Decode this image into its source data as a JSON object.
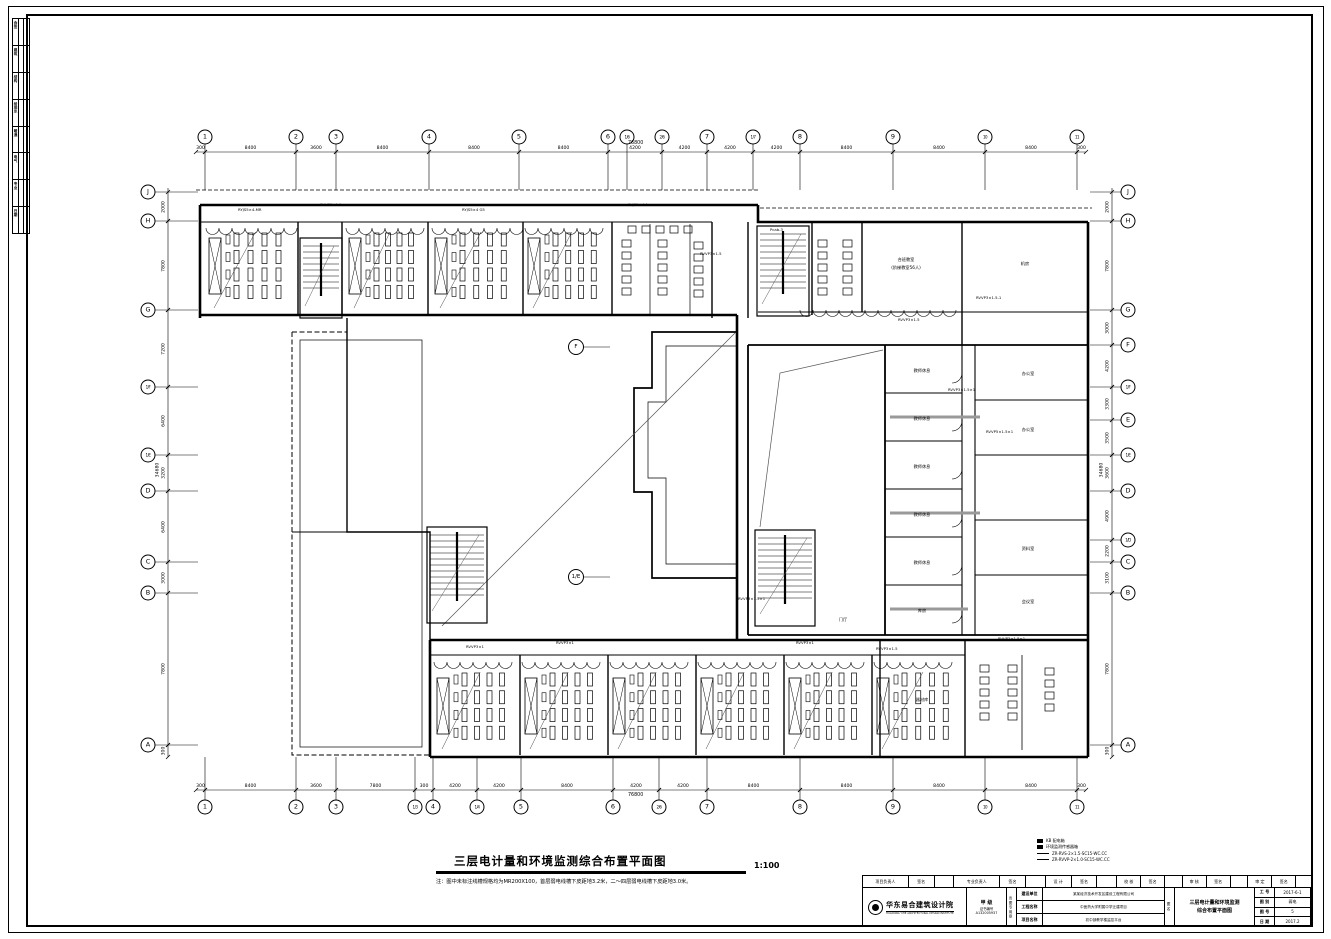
{
  "drawing": {
    "title": "三层电计量和环境监测综合布置平面图",
    "scale": "1:100",
    "note": "注：图中未标注线槽规格均为MR200X100，首层弱电线槽下皮距地3.2米，二～四层弱电线槽下皮距地3.0米。"
  },
  "legend": {
    "rows": [
      {
        "sym": "box",
        "label": "KB 配电箱"
      },
      {
        "sym": "box",
        "label": "环境监测传感器箱"
      },
      {
        "sym": "line",
        "label": "ZR-RVS-2×1.5-SC15-WC.CC"
      },
      {
        "sym": "line",
        "label": "ZR-RVVP-2×1.0-SC15-WC.CC"
      }
    ]
  },
  "signstrip": {
    "rows": [
      "会签",
      "建筑",
      "结构",
      "给排水",
      "暖通",
      "电气",
      "专业",
      "日期"
    ]
  },
  "titleblock": {
    "row1": [
      "项目负责人",
      "签名",
      "",
      "专业负责人",
      "签名",
      "",
      "设 计",
      "签名",
      "",
      "校 核",
      "签名",
      "",
      "审 核",
      "签名",
      "",
      "审 定",
      "签名",
      ""
    ],
    "company": "华东易合建筑设计院",
    "company_en": "HUADONG YIHE ARCHITECTURAL DESIGN INSTITUTE",
    "cert_grade": "甲 级",
    "cert_label": "证书编号",
    "cert_no": "A132005937",
    "stamp_vertical": "出图专用章",
    "fields": [
      {
        "label": "建设单位",
        "value": "某某经济技术开发区建设工程有限公司"
      },
      {
        "label": "工程名称",
        "value": "中医药大学附属中学迁建项目"
      },
      {
        "label": "项目名称",
        "value": "初中部教学楼监控平台"
      }
    ],
    "name_col_vertical": "图名",
    "drawing_name_line1": "三层电计量和环境监测",
    "drawing_name_line2": "综合布置平面图",
    "meta": [
      {
        "label": "工 号",
        "value": "2017-6-1"
      },
      {
        "label": "图 别",
        "value": "弱电"
      },
      {
        "label": "图 号",
        "value": "5"
      },
      {
        "label": "日 期",
        "value": "2017.2"
      }
    ]
  },
  "grid": {
    "top": [
      {
        "l": "1",
        "x": 205
      },
      {
        "l": "2",
        "x": 296
      },
      {
        "l": "3",
        "x": 336
      },
      {
        "l": "4",
        "x": 429
      },
      {
        "l": "5",
        "x": 519
      },
      {
        "l": "6",
        "x": 608
      },
      {
        "l": "1/6",
        "x": 627
      },
      {
        "l": "2/6",
        "x": 662
      },
      {
        "l": "7",
        "x": 707
      },
      {
        "l": "1/7",
        "x": 753
      },
      {
        "l": "8",
        "x": 800
      },
      {
        "l": "9",
        "x": 893
      },
      {
        "l": "10",
        "x": 985
      },
      {
        "l": "11",
        "x": 1077
      }
    ],
    "bottom": [
      {
        "l": "1",
        "x": 205
      },
      {
        "l": "2",
        "x": 296
      },
      {
        "l": "3",
        "x": 336
      },
      {
        "l": "1/3",
        "x": 415
      },
      {
        "l": "4",
        "x": 433
      },
      {
        "l": "1/4",
        "x": 477
      },
      {
        "l": "5",
        "x": 521
      },
      {
        "l": "6",
        "x": 613
      },
      {
        "l": "2/6",
        "x": 659
      },
      {
        "l": "7",
        "x": 707
      },
      {
        "l": "8",
        "x": 800
      },
      {
        "l": "9",
        "x": 893
      },
      {
        "l": "10",
        "x": 985
      },
      {
        "l": "11",
        "x": 1077
      }
    ],
    "left": [
      {
        "l": "J",
        "y": 192
      },
      {
        "l": "H",
        "y": 221
      },
      {
        "l": "G",
        "y": 310
      },
      {
        "l": "1/F",
        "y": 387
      },
      {
        "l": "1/E",
        "y": 455
      },
      {
        "l": "D",
        "y": 491
      },
      {
        "l": "C",
        "y": 562
      },
      {
        "l": "B",
        "y": 593
      },
      {
        "l": "A",
        "y": 745
      }
    ],
    "right": [
      {
        "l": "J",
        "y": 192
      },
      {
        "l": "H",
        "y": 221
      },
      {
        "l": "G",
        "y": 310
      },
      {
        "l": "F",
        "y": 345
      },
      {
        "l": "1/F",
        "y": 387
      },
      {
        "l": "E",
        "y": 420
      },
      {
        "l": "1/E",
        "y": 455
      },
      {
        "l": "D",
        "y": 491
      },
      {
        "l": "1/D",
        "y": 540
      },
      {
        "l": "C",
        "y": 562
      },
      {
        "l": "B",
        "y": 593
      },
      {
        "l": "A",
        "y": 745
      }
    ],
    "dims_top": [
      {
        "x1": 196,
        "x2": 205,
        "v": "300"
      },
      {
        "x1": 205,
        "x2": 296,
        "v": "8400"
      },
      {
        "x1": 296,
        "x2": 336,
        "v": "3600"
      },
      {
        "x1": 336,
        "x2": 429,
        "v": "8400"
      },
      {
        "x1": 429,
        "x2": 519,
        "v": "8400"
      },
      {
        "x1": 519,
        "x2": 608,
        "v": "8400"
      },
      {
        "x1": 608,
        "x2": 662,
        "v": "4200"
      },
      {
        "x1": 662,
        "x2": 707,
        "v": "4200"
      },
      {
        "x1": 707,
        "x2": 753,
        "v": "4200"
      },
      {
        "x1": 753,
        "x2": 800,
        "v": "4200"
      },
      {
        "x1": 800,
        "x2": 893,
        "v": "8400"
      },
      {
        "x1": 893,
        "x2": 985,
        "v": "8400"
      },
      {
        "x1": 985,
        "x2": 1077,
        "v": "8400"
      },
      {
        "x1": 1077,
        "x2": 1086,
        "v": "300"
      }
    ],
    "dims_bottom": [
      {
        "x1": 196,
        "x2": 205,
        "v": "300"
      },
      {
        "x1": 205,
        "x2": 296,
        "v": "8400"
      },
      {
        "x1": 296,
        "x2": 336,
        "v": "3600"
      },
      {
        "x1": 336,
        "x2": 415,
        "v": "7800"
      },
      {
        "x1": 415,
        "x2": 433,
        "v": "300"
      },
      {
        "x1": 433,
        "x2": 477,
        "v": "4200"
      },
      {
        "x1": 477,
        "x2": 521,
        "v": "4200"
      },
      {
        "x1": 521,
        "x2": 613,
        "v": "8400"
      },
      {
        "x1": 613,
        "x2": 659,
        "v": "4200"
      },
      {
        "x1": 659,
        "x2": 707,
        "v": "4200"
      },
      {
        "x1": 707,
        "x2": 800,
        "v": "8400"
      },
      {
        "x1": 800,
        "x2": 893,
        "v": "8400"
      },
      {
        "x1": 893,
        "x2": 985,
        "v": "8400"
      },
      {
        "x1": 985,
        "x2": 1077,
        "v": "8400"
      },
      {
        "x1": 1077,
        "x2": 1086,
        "v": "300"
      }
    ],
    "dims_left": [
      {
        "y1": 192,
        "y2": 221,
        "v": "2000"
      },
      {
        "y1": 221,
        "y2": 310,
        "v": "7800"
      },
      {
        "y1": 310,
        "y2": 387,
        "v": "7200"
      },
      {
        "y1": 387,
        "y2": 455,
        "v": "6400"
      },
      {
        "y1": 455,
        "y2": 491,
        "v": "3200"
      },
      {
        "y1": 491,
        "y2": 562,
        "v": "6400"
      },
      {
        "y1": 562,
        "y2": 593,
        "v": "3000"
      },
      {
        "y1": 593,
        "y2": 745,
        "v": "7800"
      },
      {
        "y1": 745,
        "y2": 757,
        "v": "300"
      }
    ],
    "dims_right": [
      {
        "y1": 192,
        "y2": 221,
        "v": "2000"
      },
      {
        "y1": 221,
        "y2": 310,
        "v": "7800"
      },
      {
        "y1": 310,
        "y2": 345,
        "v": "3000"
      },
      {
        "y1": 345,
        "y2": 387,
        "v": "4200"
      },
      {
        "y1": 387,
        "y2": 420,
        "v": "3300"
      },
      {
        "y1": 420,
        "y2": 455,
        "v": "3500"
      },
      {
        "y1": 455,
        "y2": 491,
        "v": "3600"
      },
      {
        "y1": 491,
        "y2": 540,
        "v": "4900"
      },
      {
        "y1": 540,
        "y2": 562,
        "v": "2200"
      },
      {
        "y1": 562,
        "y2": 593,
        "v": "3100"
      },
      {
        "y1": 593,
        "y2": 745,
        "v": "7800"
      },
      {
        "y1": 745,
        "y2": 757,
        "v": "300"
      }
    ],
    "total_top": "76800",
    "total_bottom": "76800",
    "total_left": "34680",
    "total_right": "34680"
  },
  "axis_refs": [
    {
      "label": "F",
      "x": 576,
      "y": 347
    },
    {
      "label": "1/E",
      "x": 576,
      "y": 577
    }
  ],
  "plan_labels": [
    {
      "x": 906,
      "y": 260,
      "t": "合班教室"
    },
    {
      "x": 906,
      "y": 268,
      "t": "(阶梯教室56人)"
    },
    {
      "x": 1025,
      "y": 264,
      "t": "机房"
    },
    {
      "x": 922,
      "y": 371,
      "t": "教师休息"
    },
    {
      "x": 922,
      "y": 419,
      "t": "教师休息"
    },
    {
      "x": 922,
      "y": 467,
      "t": "教师休息"
    },
    {
      "x": 922,
      "y": 515,
      "t": "教师休息"
    },
    {
      "x": 922,
      "y": 563,
      "t": "教师休息"
    },
    {
      "x": 922,
      "y": 611,
      "t": "库房"
    },
    {
      "x": 1028,
      "y": 374,
      "t": "办公室"
    },
    {
      "x": 1028,
      "y": 430,
      "t": "办公室"
    },
    {
      "x": 1028,
      "y": 549,
      "t": "资料室"
    },
    {
      "x": 1028,
      "y": 602,
      "t": "会议室"
    },
    {
      "x": 922,
      "y": 700,
      "t": "器材库"
    },
    {
      "x": 843,
      "y": 620,
      "t": "门厅"
    }
  ],
  "cable_labels": [
    {
      "x": 238,
      "y": 212,
      "t": "RYJS5×4-MR"
    },
    {
      "x": 320,
      "y": 207,
      "t": "RVVP3×1.5"
    },
    {
      "x": 462,
      "y": 212,
      "t": "RYJS5×4 G5"
    },
    {
      "x": 628,
      "y": 207,
      "t": "RYJS5×4-1"
    },
    {
      "x": 700,
      "y": 256,
      "t": "RVVP3×1.5"
    },
    {
      "x": 770,
      "y": 232,
      "t": "Pcab-3"
    },
    {
      "x": 898,
      "y": 322,
      "t": "RVVP3×1.5"
    },
    {
      "x": 976,
      "y": 300,
      "t": "RVVP3×1.5-1"
    },
    {
      "x": 948,
      "y": 392,
      "t": "RVVP3×1.5×1"
    },
    {
      "x": 986,
      "y": 434,
      "t": "RVVP5×1.5×1"
    },
    {
      "x": 998,
      "y": 641,
      "t": "RVVP3×1.5×1"
    },
    {
      "x": 466,
      "y": 649,
      "t": "RVVP3×1"
    },
    {
      "x": 556,
      "y": 645,
      "t": "RVVP3×1"
    },
    {
      "x": 796,
      "y": 645,
      "t": "RVVP3×1"
    },
    {
      "x": 876,
      "y": 651,
      "t": "RVVP3×1.5"
    },
    {
      "x": 738,
      "y": 601,
      "t": "RVVP3×1.5×1"
    }
  ]
}
